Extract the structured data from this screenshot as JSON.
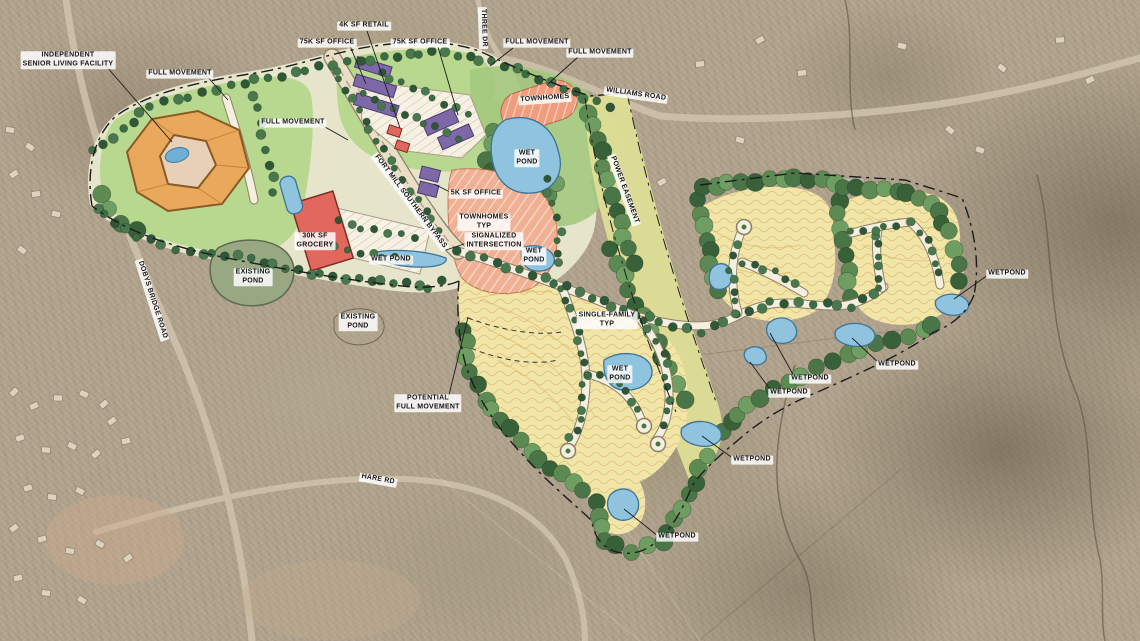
{
  "map": {
    "type": "master-plan-site-aerial",
    "labels": [
      {
        "id": "independent-senior-living-facility",
        "text": "INDEPENDENT\nSENIOR LIVING FACILITY",
        "x": 68,
        "y": 60,
        "rotate": 0
      },
      {
        "id": "full-movement-1",
        "text": "FULL MOVEMENT",
        "x": 180,
        "y": 74,
        "rotate": 0
      },
      {
        "id": "retail-4k",
        "text": "4K SF RETAIL",
        "x": 364,
        "y": 26,
        "rotate": 0
      },
      {
        "id": "office-75k-west",
        "text": "75K SF OFFICE",
        "x": 327,
        "y": 43,
        "rotate": 0
      },
      {
        "id": "office-75k-east",
        "text": "75K SF OFFICE",
        "x": 420,
        "y": 43,
        "rotate": 0
      },
      {
        "id": "full-movement-2",
        "text": "FULL MOVEMENT",
        "x": 537,
        "y": 43,
        "rotate": 0
      },
      {
        "id": "full-movement-3",
        "text": "FULL MOVEMENT",
        "x": 600,
        "y": 53,
        "rotate": 0
      },
      {
        "id": "townhomes-north",
        "text": "TOWNHOMES",
        "x": 545,
        "y": 99,
        "rotate": -4
      },
      {
        "id": "williams-road",
        "text": "WILLIAMS ROAD",
        "x": 636,
        "y": 95,
        "rotate": 8
      },
      {
        "id": "three-dr",
        "text": "THREE DR",
        "x": 483,
        "y": 28,
        "rotate": 88
      },
      {
        "id": "full-movement-4",
        "text": "FULL MOVEMENT",
        "x": 293,
        "y": 123,
        "rotate": 0
      },
      {
        "id": "wet-pond-north",
        "text": "WET\nPOND",
        "x": 527,
        "y": 158,
        "rotate": 0
      },
      {
        "id": "fort-mill-southern-bypass",
        "text": "FORT MILL SOUTHERN BYPASS",
        "x": 410,
        "y": 202,
        "rotate": 53
      },
      {
        "id": "office-5k",
        "text": "5K SF OFFICE",
        "x": 476,
        "y": 194,
        "rotate": 0
      },
      {
        "id": "townhomes-typ",
        "text": "TOWNHOMES\nTYP",
        "x": 484,
        "y": 222,
        "rotate": 0
      },
      {
        "id": "signalized-intersection",
        "text": "SIGNALIZED\nINTERSECTION",
        "x": 494,
        "y": 241,
        "rotate": 0
      },
      {
        "id": "grocery-30k",
        "text": "30K SF\nGROCERY",
        "x": 315,
        "y": 241,
        "rotate": 0
      },
      {
        "id": "wet-pond-grocery",
        "text": "WET POND",
        "x": 391,
        "y": 260,
        "rotate": 0
      },
      {
        "id": "existing-pond-west",
        "text": "EXISTING\nPOND",
        "x": 253,
        "y": 277,
        "rotate": 0
      },
      {
        "id": "dobys-bridge-road",
        "text": "DOBYS BRIDGE ROAD",
        "x": 152,
        "y": 300,
        "rotate": 72
      },
      {
        "id": "existing-pond-south",
        "text": "EXISTING\nPOND",
        "x": 358,
        "y": 322,
        "rotate": 0
      },
      {
        "id": "single-family-typ",
        "text": "SINGLE-FAMILY\nTYP",
        "x": 607,
        "y": 320,
        "rotate": 0
      },
      {
        "id": "wet-pond-pod-a",
        "text": "WET\nPOND",
        "x": 620,
        "y": 374,
        "rotate": 0
      },
      {
        "id": "wet-pond-small",
        "text": "WET\nPOND",
        "x": 534,
        "y": 256,
        "rotate": 0
      },
      {
        "id": "potential-full-movement",
        "text": "POTENTIAL\nFULL MOVEMENT",
        "x": 428,
        "y": 403,
        "rotate": 0
      },
      {
        "id": "wetpond-ne",
        "text": "WETPOND",
        "x": 897,
        "y": 365,
        "rotate": 0
      },
      {
        "id": "wetpond-mid-1",
        "text": "WETPOND",
        "x": 810,
        "y": 379,
        "rotate": 0
      },
      {
        "id": "wetpond-mid-2",
        "text": "WETPOND",
        "x": 789,
        "y": 393,
        "rotate": 0
      },
      {
        "id": "wetpond-south-1",
        "text": "WETPOND",
        "x": 752,
        "y": 460,
        "rotate": 0
      },
      {
        "id": "wetpond-south-2",
        "text": "WETPOND",
        "x": 677,
        "y": 537,
        "rotate": 0
      },
      {
        "id": "wetpond-east",
        "text": "WETPOND",
        "x": 1007,
        "y": 274,
        "rotate": 0
      },
      {
        "id": "hare-rd",
        "text": "HARE RD",
        "x": 378,
        "y": 480,
        "rotate": 10
      },
      {
        "id": "power-easement",
        "text": "POWER EASEMENT",
        "x": 624,
        "y": 190,
        "rotate": 70
      }
    ],
    "colors": {
      "single_family_yellow": "#f1e5a8",
      "lawn_green": "#b7d88e",
      "tree_green_dark": "#3d6b44",
      "buffer_green": "#4a7547",
      "pond_blue": "#8fc3de",
      "townhomes_salmon": "#efae8e",
      "office_purple": "#7e68a8",
      "retail_red": "#de685c",
      "senior_living_orange": "#eaa85c",
      "easement_yellow_green": "#dede96",
      "plan_road_cream": "#f4efdf",
      "aerial_base_tan": "#b2a48e"
    }
  }
}
